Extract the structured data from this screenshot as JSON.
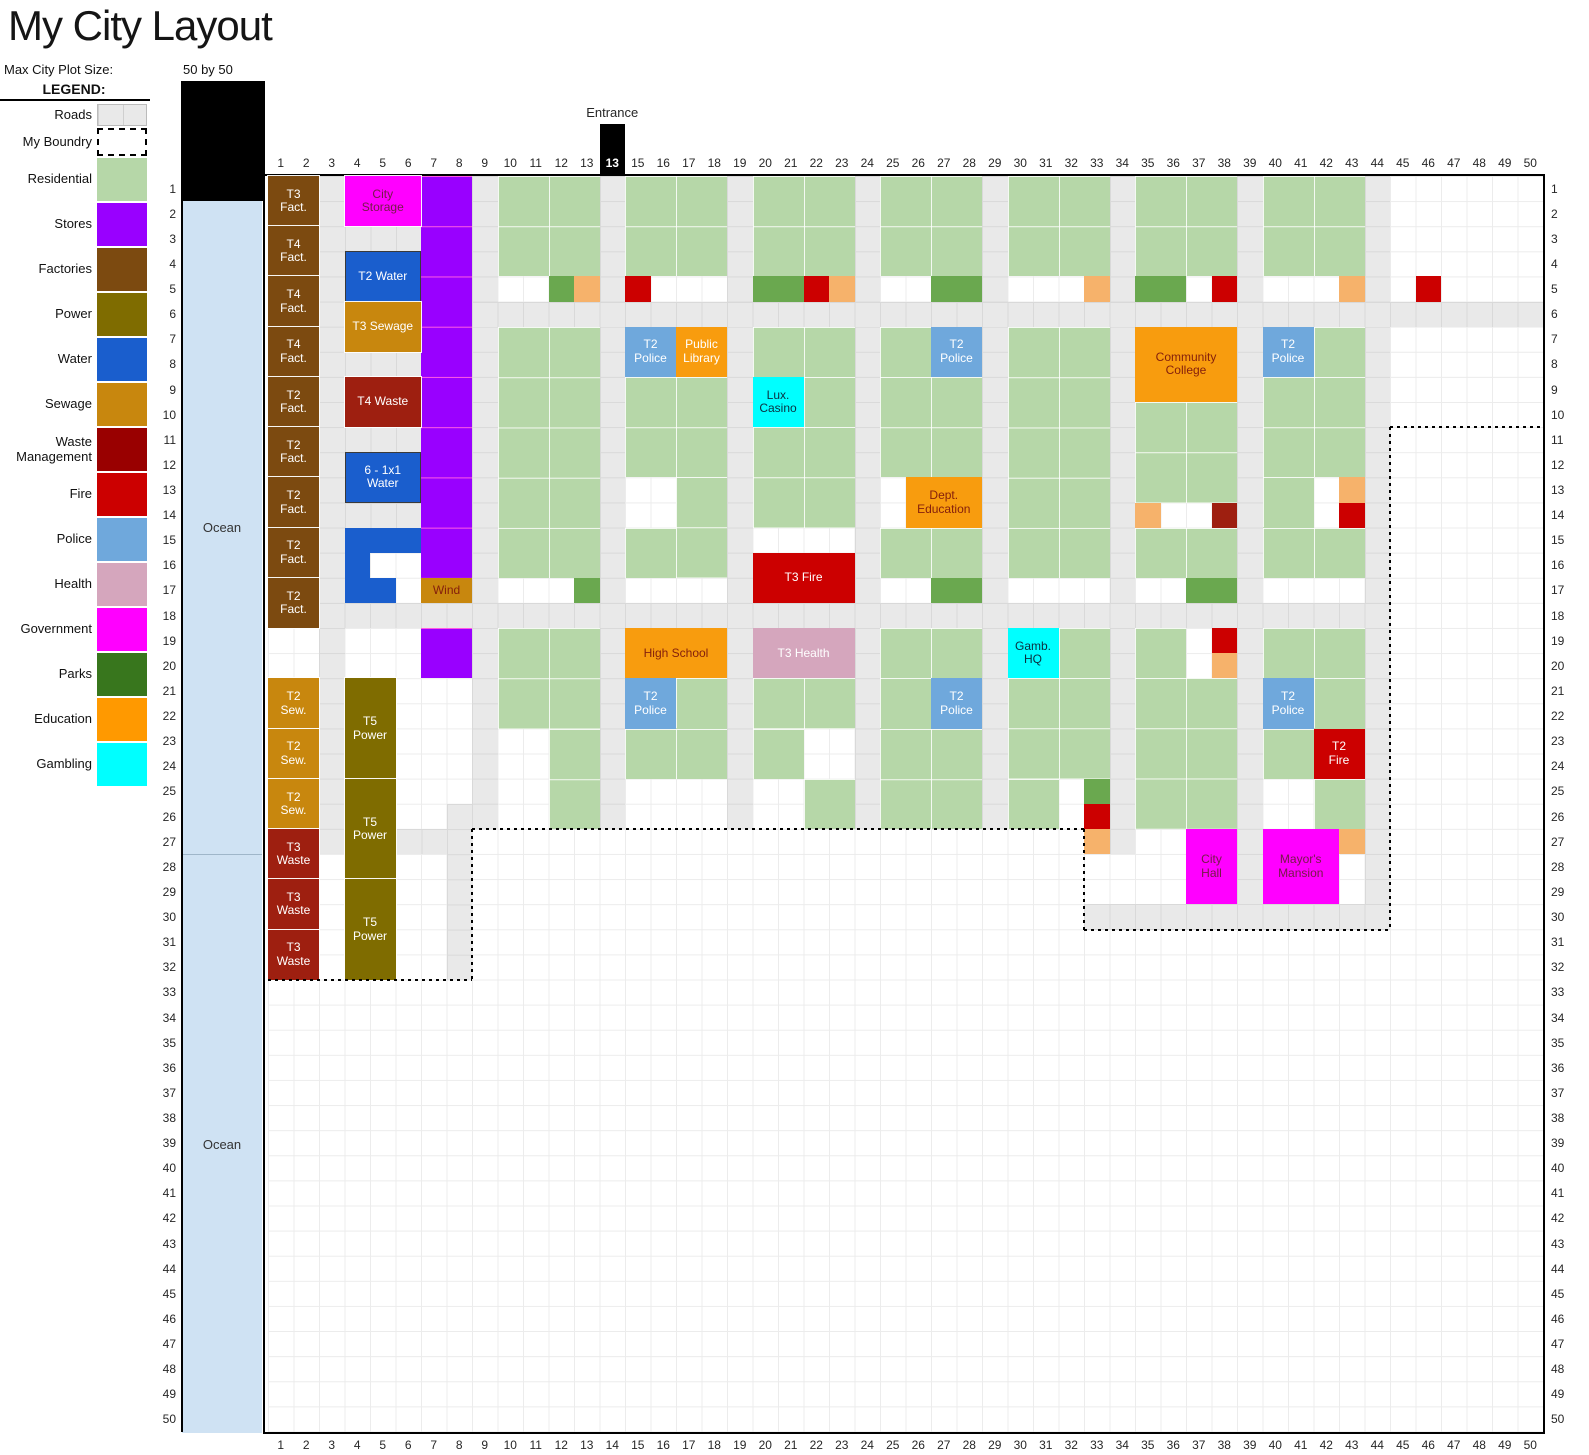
{
  "title": "My City Layout",
  "plot_size": {
    "label": "Max City Plot Size:",
    "value": "50 by 50"
  },
  "legend": {
    "title": "LEGEND:",
    "items": [
      {
        "label": "Roads",
        "swatch": "roads"
      },
      {
        "label": "My Boundry",
        "swatch": "boundary"
      },
      {
        "label": "Residential",
        "color": "#b6d7a8"
      },
      {
        "label": "Stores",
        "color": "#9900ff"
      },
      {
        "label": "Factories",
        "color": "#7c4a10"
      },
      {
        "label": "Power",
        "color": "#7f6c00"
      },
      {
        "label": "Water",
        "color": "#1a5ecd"
      },
      {
        "label": "Sewage",
        "color": "#c8870e"
      },
      {
        "label": "Waste\nManagement",
        "color": "#990000"
      },
      {
        "label": "Fire",
        "color": "#cc0000"
      },
      {
        "label": "Police",
        "color": "#6fa8dc"
      },
      {
        "label": "Health",
        "color": "#d5a6bd"
      },
      {
        "label": "Government",
        "color": "#ff00ff"
      },
      {
        "label": "Parks",
        "color": "#38761d"
      },
      {
        "label": "Education",
        "color": "#ff9900"
      },
      {
        "label": "Gambling",
        "color": "#00ffff"
      }
    ]
  },
  "grid": {
    "cols": 50,
    "rows": 50,
    "axis_start": 1,
    "axis_end": 50
  },
  "entrance": {
    "label": "Entrance",
    "column": 14,
    "header_text": "13"
  },
  "ocean": {
    "label": "Ocean",
    "sections": [
      {
        "r1": 2,
        "r2": 28
      },
      {
        "r1": 28,
        "r2": 51
      }
    ]
  },
  "map": {
    "palette": {
      "residential": "#b6d7a8",
      "stores": "#9900ff",
      "factory": "#7c4a10",
      "power": "#7f6c00",
      "water": "#1a5ecd",
      "sewage": "#c8870e",
      "waste": "#9e1f10",
      "fire": "#cc0000",
      "police": "#6fa8dc",
      "health": "#d5a6bd",
      "government": "#ff00ff",
      "park": "#6aa84f",
      "education": "#f89c0e",
      "gambling": "#00ffff",
      "road": "#e9e9e9",
      "light_orange": "#f6b26b",
      "ocean": "#cfe2f3"
    },
    "roads": [
      {
        "c": 3,
        "r": 1,
        "w": 1,
        "h": 27
      },
      {
        "c": 9,
        "r": 1,
        "w": 1,
        "h": 26
      },
      {
        "c": 14,
        "r": 1,
        "w": 1,
        "h": 26
      },
      {
        "c": 19,
        "r": 1,
        "w": 1,
        "h": 26
      },
      {
        "c": 24,
        "r": 1,
        "w": 1,
        "h": 26
      },
      {
        "c": 29,
        "r": 1,
        "w": 1,
        "h": 26
      },
      {
        "c": 34,
        "r": 1,
        "w": 1,
        "h": 27
      },
      {
        "c": 39,
        "r": 1,
        "w": 1,
        "h": 29
      },
      {
        "c": 44,
        "r": 1,
        "w": 1,
        "h": 30
      },
      {
        "c": 9,
        "r": 6,
        "w": 42,
        "h": 1
      },
      {
        "c": 3,
        "r": 18,
        "w": 42,
        "h": 1
      },
      {
        "c": 33,
        "r": 30,
        "w": 12,
        "h": 1
      },
      {
        "c": 8,
        "r": 26,
        "w": 1,
        "h": 7
      },
      {
        "c": 4,
        "r": 3,
        "w": 3,
        "h": 1
      },
      {
        "c": 4,
        "r": 8,
        "w": 3,
        "h": 1
      },
      {
        "c": 4,
        "r": 11,
        "w": 3,
        "h": 1
      },
      {
        "c": 4,
        "r": 14,
        "w": 3,
        "h": 1
      },
      {
        "c": 6,
        "r": 27,
        "w": 2,
        "h": 1
      }
    ],
    "residential": [
      [
        10,
        1,
        4,
        4
      ],
      [
        15,
        1,
        4,
        4
      ],
      [
        20,
        1,
        4,
        4
      ],
      [
        25,
        1,
        4,
        4
      ],
      [
        30,
        1,
        4,
        4
      ],
      [
        35,
        1,
        4,
        4
      ],
      [
        40,
        1,
        4,
        4
      ],
      [
        10,
        7,
        4,
        10
      ],
      [
        15,
        9,
        4,
        4
      ],
      [
        17,
        13,
        2,
        4
      ],
      [
        15,
        15,
        2,
        2
      ],
      [
        20,
        7,
        4,
        2
      ],
      [
        22,
        9,
        2,
        2
      ],
      [
        20,
        11,
        4,
        4
      ],
      [
        25,
        7,
        2,
        2
      ],
      [
        25,
        9,
        4,
        4
      ],
      [
        25,
        15,
        4,
        2
      ],
      [
        30,
        7,
        4,
        10
      ],
      [
        35,
        10,
        4,
        4
      ],
      [
        35,
        15,
        4,
        2
      ],
      [
        42,
        7,
        2,
        2
      ],
      [
        40,
        9,
        4,
        4
      ],
      [
        40,
        13,
        2,
        2
      ],
      [
        40,
        15,
        4,
        2
      ],
      [
        10,
        19,
        4,
        4
      ],
      [
        12,
        23,
        2,
        4
      ],
      [
        17,
        21,
        2,
        2
      ],
      [
        15,
        23,
        4,
        2
      ],
      [
        20,
        21,
        4,
        2
      ],
      [
        20,
        23,
        2,
        2
      ],
      [
        22,
        25,
        2,
        2
      ],
      [
        25,
        19,
        4,
        2
      ],
      [
        25,
        21,
        2,
        2
      ],
      [
        25,
        23,
        4,
        4
      ],
      [
        32,
        19,
        2,
        2
      ],
      [
        30,
        21,
        4,
        4
      ],
      [
        30,
        25,
        2,
        2
      ],
      [
        35,
        19,
        2,
        2
      ],
      [
        35,
        21,
        4,
        6
      ],
      [
        40,
        19,
        4,
        2
      ],
      [
        42,
        21,
        2,
        2
      ],
      [
        40,
        23,
        2,
        2
      ],
      [
        42,
        25,
        2,
        2
      ]
    ],
    "stores": [
      {
        "c": 7,
        "r": 1,
        "w": 2,
        "h": 16
      },
      {
        "c": 7,
        "r": 19,
        "w": 2,
        "h": 2
      }
    ],
    "cells": [
      {
        "c": 4,
        "r": 15,
        "t": "water"
      },
      {
        "c": 5,
        "r": 15,
        "t": "water"
      },
      {
        "c": 6,
        "r": 15,
        "t": "water"
      },
      {
        "c": 4,
        "r": 16,
        "t": "water"
      },
      {
        "c": 4,
        "r": 17,
        "t": "water"
      },
      {
        "c": 5,
        "r": 17,
        "t": "water"
      },
      {
        "c": 12,
        "r": 5,
        "t": "park"
      },
      {
        "c": 20,
        "r": 5,
        "t": "park"
      },
      {
        "c": 21,
        "r": 5,
        "t": "park"
      },
      {
        "c": 27,
        "r": 5,
        "t": "park"
      },
      {
        "c": 28,
        "r": 5,
        "t": "park"
      },
      {
        "c": 35,
        "r": 5,
        "t": "park"
      },
      {
        "c": 36,
        "r": 5,
        "t": "park"
      },
      {
        "c": 13,
        "r": 17,
        "t": "park"
      },
      {
        "c": 27,
        "r": 17,
        "t": "park"
      },
      {
        "c": 28,
        "r": 17,
        "t": "park"
      },
      {
        "c": 37,
        "r": 17,
        "t": "park"
      },
      {
        "c": 38,
        "r": 17,
        "t": "park"
      },
      {
        "c": 33,
        "r": 25,
        "t": "park"
      },
      {
        "c": 13,
        "r": 5,
        "t": "light_orange"
      },
      {
        "c": 23,
        "r": 5,
        "t": "light_orange"
      },
      {
        "c": 33,
        "r": 5,
        "t": "light_orange"
      },
      {
        "c": 43,
        "r": 5,
        "t": "light_orange"
      },
      {
        "c": 43,
        "r": 13,
        "t": "light_orange"
      },
      {
        "c": 35,
        "r": 14,
        "t": "light_orange"
      },
      {
        "c": 38,
        "r": 20,
        "t": "light_orange"
      },
      {
        "c": 33,
        "r": 27,
        "t": "light_orange"
      },
      {
        "c": 43,
        "r": 27,
        "t": "light_orange"
      },
      {
        "c": 15,
        "r": 5,
        "t": "fire"
      },
      {
        "c": 22,
        "r": 5,
        "t": "fire"
      },
      {
        "c": 38,
        "r": 5,
        "t": "fire"
      },
      {
        "c": 46,
        "r": 5,
        "t": "fire"
      },
      {
        "c": 43,
        "r": 14,
        "t": "fire"
      },
      {
        "c": 38,
        "r": 19,
        "t": "fire"
      },
      {
        "c": 33,
        "r": 26,
        "t": "fire"
      },
      {
        "c": 38,
        "r": 14,
        "t": "waste"
      }
    ],
    "buildings": [
      {
        "label": "T3\nFact.",
        "type": "factory",
        "c": 1,
        "r": 1,
        "w": 2,
        "h": 2
      },
      {
        "label": "T4\nFact.",
        "type": "factory",
        "c": 1,
        "r": 3,
        "w": 2,
        "h": 2
      },
      {
        "label": "T4\nFact.",
        "type": "factory",
        "c": 1,
        "r": 5,
        "w": 2,
        "h": 2
      },
      {
        "label": "T4\nFact.",
        "type": "factory",
        "c": 1,
        "r": 7,
        "w": 2,
        "h": 2
      },
      {
        "label": "T2\nFact.",
        "type": "factory",
        "c": 1,
        "r": 9,
        "w": 2,
        "h": 2
      },
      {
        "label": "T2\nFact.",
        "type": "factory",
        "c": 1,
        "r": 11,
        "w": 2,
        "h": 2
      },
      {
        "label": "T2\nFact.",
        "type": "factory",
        "c": 1,
        "r": 13,
        "w": 2,
        "h": 2
      },
      {
        "label": "T2\nFact.",
        "type": "factory",
        "c": 1,
        "r": 15,
        "w": 2,
        "h": 2
      },
      {
        "label": "T2\nFact.",
        "type": "factory",
        "c": 1,
        "r": 17,
        "w": 2,
        "h": 2
      },
      {
        "label": "City\nStorage",
        "type": "government",
        "c": 4,
        "r": 1,
        "w": 3,
        "h": 2,
        "text": "#741b47"
      },
      {
        "label": "T2 Water",
        "type": "water",
        "c": 4,
        "r": 4,
        "w": 3,
        "h": 2,
        "darkBorder": true
      },
      {
        "label": "T3 Sewage",
        "type": "sewage",
        "c": 4,
        "r": 6,
        "w": 3,
        "h": 2
      },
      {
        "label": "T4 Waste",
        "type": "waste",
        "c": 4,
        "r": 9,
        "w": 3,
        "h": 2
      },
      {
        "label": "6 - 1x1\nWater",
        "type": "water",
        "c": 4,
        "r": 12,
        "w": 3,
        "h": 2,
        "darkBorder": true
      },
      {
        "label": "Wind",
        "type": "sewage",
        "c": 7,
        "r": 17,
        "w": 2,
        "h": 1,
        "text": "#85200c"
      },
      {
        "label": "T2\nSew.",
        "type": "sewage",
        "c": 1,
        "r": 21,
        "w": 2,
        "h": 2
      },
      {
        "label": "T2\nSew.",
        "type": "sewage",
        "c": 1,
        "r": 23,
        "w": 2,
        "h": 2
      },
      {
        "label": "T2\nSew.",
        "type": "sewage",
        "c": 1,
        "r": 25,
        "w": 2,
        "h": 2
      },
      {
        "label": "T3\nWaste",
        "type": "waste",
        "c": 1,
        "r": 27,
        "w": 2,
        "h": 2
      },
      {
        "label": "T3\nWaste",
        "type": "waste",
        "c": 1,
        "r": 29,
        "w": 2,
        "h": 2
      },
      {
        "label": "T3\nWaste",
        "type": "waste",
        "c": 1,
        "r": 31,
        "w": 2,
        "h": 2
      },
      {
        "label": "T5\nPower",
        "type": "power",
        "c": 4,
        "r": 21,
        "w": 2,
        "h": 4
      },
      {
        "label": "T5\nPower",
        "type": "power",
        "c": 4,
        "r": 25,
        "w": 2,
        "h": 4
      },
      {
        "label": "T5\nPower",
        "type": "power",
        "c": 4,
        "r": 29,
        "w": 2,
        "h": 4
      },
      {
        "label": "T2\nPolice",
        "type": "police",
        "c": 15,
        "r": 7,
        "w": 2,
        "h": 2
      },
      {
        "label": "Public\nLibrary",
        "type": "education",
        "c": 17,
        "r": 7,
        "w": 2,
        "h": 2
      },
      {
        "label": "T2\nPolice",
        "type": "police",
        "c": 27,
        "r": 7,
        "w": 2,
        "h": 2
      },
      {
        "label": "Community\nCollege",
        "type": "education",
        "c": 35,
        "r": 7,
        "w": 4,
        "h": 3,
        "text": "#85200c"
      },
      {
        "label": "T2\nPolice",
        "type": "police",
        "c": 40,
        "r": 7,
        "w": 2,
        "h": 2
      },
      {
        "label": "Lux.\nCasino",
        "type": "gambling",
        "c": 20,
        "r": 9,
        "w": 2,
        "h": 2,
        "text": "#0b3040"
      },
      {
        "label": "Dept.\nEducation",
        "type": "education",
        "c": 26,
        "r": 13,
        "w": 3,
        "h": 2,
        "text": "#85200c"
      },
      {
        "label": "T3 Fire",
        "type": "fire",
        "c": 20,
        "r": 16,
        "w": 4,
        "h": 2
      },
      {
        "label": "High School",
        "type": "education",
        "c": 15,
        "r": 19,
        "w": 4,
        "h": 2,
        "text": "#85200c"
      },
      {
        "label": "T3 Health",
        "type": "health",
        "c": 20,
        "r": 19,
        "w": 4,
        "h": 2
      },
      {
        "label": "Gamb.\nHQ",
        "type": "gambling",
        "c": 30,
        "r": 19,
        "w": 2,
        "h": 2,
        "text": "#0b3040"
      },
      {
        "label": "T2\nPolice",
        "type": "police",
        "c": 15,
        "r": 21,
        "w": 2,
        "h": 2
      },
      {
        "label": "T2\nPolice",
        "type": "police",
        "c": 27,
        "r": 21,
        "w": 2,
        "h": 2
      },
      {
        "label": "T2\nPolice",
        "type": "police",
        "c": 40,
        "r": 21,
        "w": 2,
        "h": 2
      },
      {
        "label": "T2\nFire",
        "type": "fire",
        "c": 42,
        "r": 23,
        "w": 2,
        "h": 2
      },
      {
        "label": "City\nHall",
        "type": "government",
        "c": 37,
        "r": 27,
        "w": 2,
        "h": 3,
        "text": "#741b47"
      },
      {
        "label": "Mayor's\nMansion",
        "type": "government",
        "c": 40,
        "r": 27,
        "w": 3,
        "h": 3,
        "text": "#741b47"
      }
    ],
    "boundary": [
      {
        "o": "h",
        "row": 11,
        "c1": 45,
        "c2": 51
      },
      {
        "o": "v",
        "col": 45,
        "r1": 11,
        "r2": 31
      },
      {
        "o": "h",
        "row": 31,
        "c1": 33,
        "c2": 45
      },
      {
        "o": "v",
        "col": 33,
        "r1": 27,
        "r2": 31
      },
      {
        "o": "h",
        "row": 27,
        "c1": 9,
        "c2": 33
      },
      {
        "o": "v",
        "col": 9,
        "r1": 27,
        "r2": 33
      },
      {
        "o": "h",
        "row": 33,
        "c1": 1,
        "c2": 9
      }
    ]
  }
}
